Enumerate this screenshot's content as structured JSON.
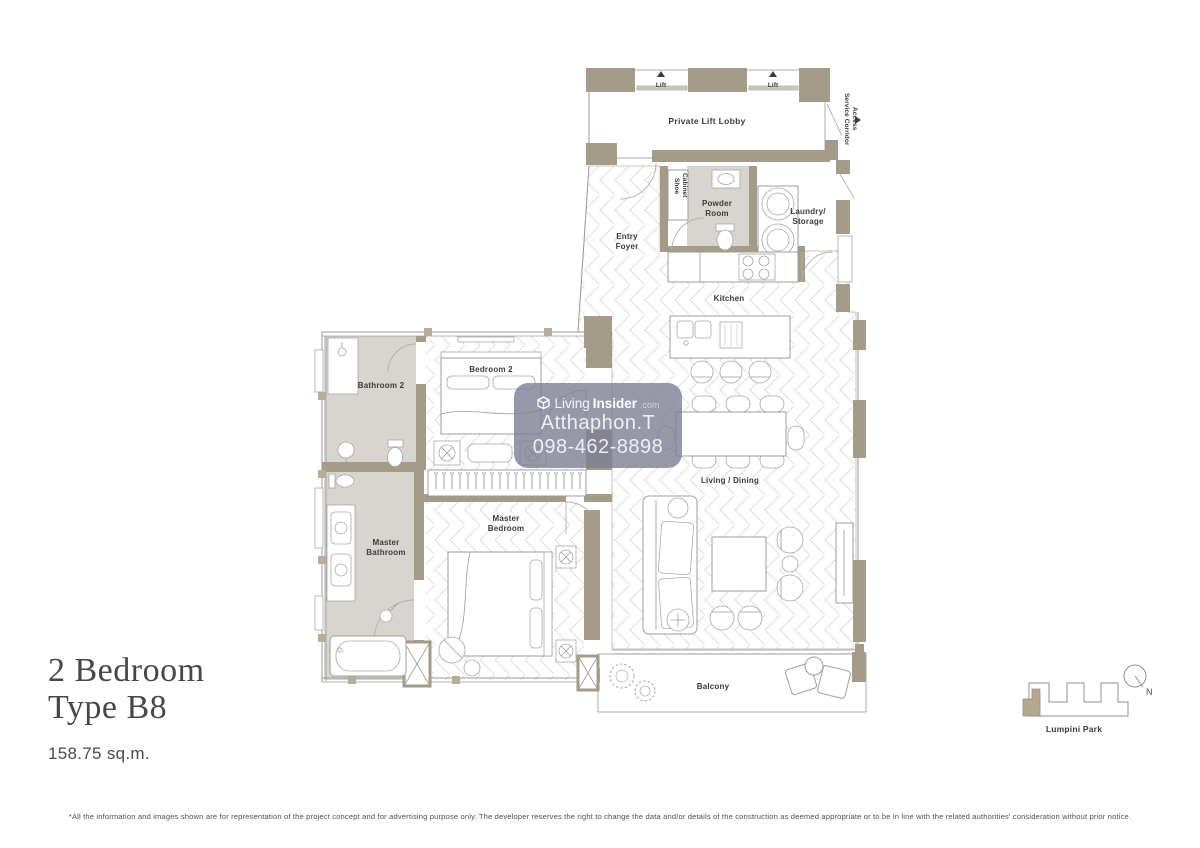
{
  "plan": {
    "unit_title_line1": "2 Bedroom",
    "unit_title_line2": "Type B8",
    "unit_area": "158.75 sq.m.",
    "disclaimer": "*All the information and images shown are for representation of the project concept and for advertising purpose only. The developer reserves the right to change the data and/or details of the construction as deemed appropriate or to be in line with the related authorities' consideration without prior notice."
  },
  "labels": {
    "lift": "Lift",
    "lobby": "Private Lift Lobby",
    "service1": "Service Corridor",
    "service2": "Access",
    "shoe1": "Shoe",
    "shoe2": "Cabinet",
    "powder1": "Powder",
    "powder2": "Room",
    "laundry1": "Laundry/",
    "laundry2": "Storage",
    "foyer1": "Entry",
    "foyer2": "Foyer",
    "kitchen": "Kitchen",
    "living": "Living / Dining",
    "balcony": "Balcony",
    "bedroom2": "Bedroom 2",
    "bathroom2": "Bathroom 2",
    "master_bed1": "Master",
    "master_bed2": "Bedroom",
    "master_bath1": "Master",
    "master_bath2": "Bathroom"
  },
  "watermark": {
    "brand_living": "Living",
    "brand_insider": "Insider",
    "brand_tld": ".com",
    "agent_name": "Atthaphon.T",
    "agent_phone": "098-462-8898"
  },
  "keyplan": {
    "park": "Lumpini Park",
    "north": "N"
  },
  "colors": {
    "wall": "#a49b88",
    "wall2": "#b6ae9d",
    "bath": "#d8d4cf",
    "balconyfloor": "#e9e6db",
    "line": "#9a9a9a",
    "floorline": "#e1dfda",
    "label": "#3b3b3b",
    "title": "#474747",
    "keyfill": "#b5a88f",
    "wm": "rgba(125,127,147,0.8)"
  }
}
